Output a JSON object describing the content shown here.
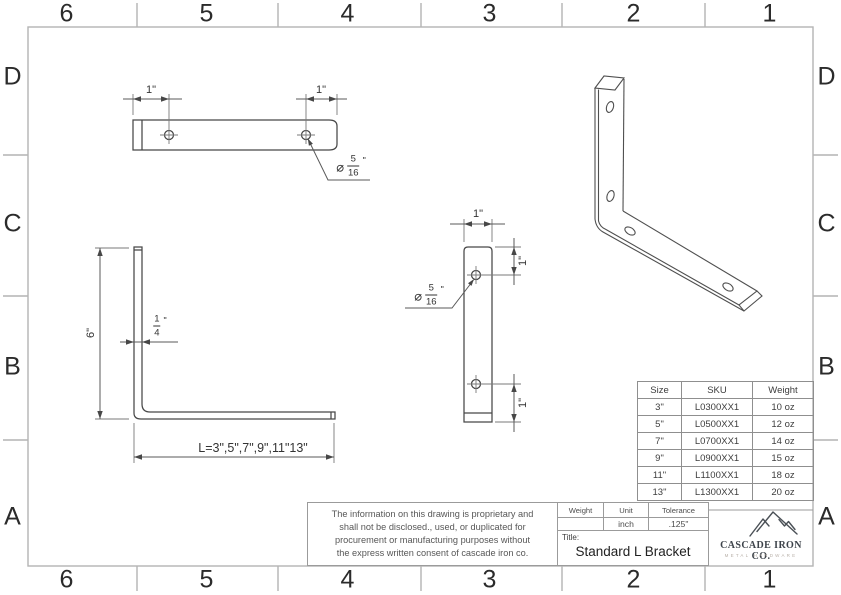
{
  "sheet": {
    "border": {
      "columns": [
        "6",
        "5",
        "4",
        "3",
        "2",
        "1"
      ],
      "rows": [
        "D",
        "C",
        "B",
        "A"
      ]
    }
  },
  "views": {
    "top": {
      "left_hole_offset": "1\"",
      "right_hole_offset": "1\"",
      "hole_note": {
        "symbol": "⌀",
        "num": "5",
        "den": "16",
        "unit": "\""
      }
    },
    "side": {
      "leg_height": "6\"",
      "thickness": {
        "num": "1",
        "den": "4",
        "unit": "\""
      },
      "length_options": "L=3\",5\",7\",9\",11\"13\""
    },
    "front": {
      "width": "1\"",
      "top_hole_offset": "1\"",
      "bottom_hole_offset": "1\"",
      "hole_note": {
        "symbol": "⌀",
        "num": "5",
        "den": "16",
        "unit": "\""
      }
    }
  },
  "size_table": {
    "headers": [
      "Size",
      "SKU",
      "Weight"
    ],
    "rows": [
      [
        "3\"",
        "L0300XX1",
        "10 oz"
      ],
      [
        "5\"",
        "L0500XX1",
        "12 oz"
      ],
      [
        "7\"",
        "L0700XX1",
        "14 oz"
      ],
      [
        "9\"",
        "L0900XX1",
        "15 oz"
      ],
      [
        "11\"",
        "L1100XX1",
        "18 oz"
      ],
      [
        "13\"",
        "L1300XX1",
        "20 oz"
      ]
    ]
  },
  "title_block": {
    "disclaimer_lines": [
      "The information on this drawing is proprietary and",
      "shall not be disclosed., used, or duplicated for",
      "procurement or manufacturing purposes without",
      "the express written consent of cascade iron co."
    ],
    "spec": {
      "headers": [
        "Weight",
        "Unit",
        "Tolerance"
      ],
      "values": [
        "",
        "inch",
        ".125\""
      ]
    },
    "title_label": "Title:",
    "title": "Standard L Bracket",
    "logo": {
      "company": "CASCADE IRON CO.",
      "tagline": "METAL HARDWARE"
    }
  }
}
